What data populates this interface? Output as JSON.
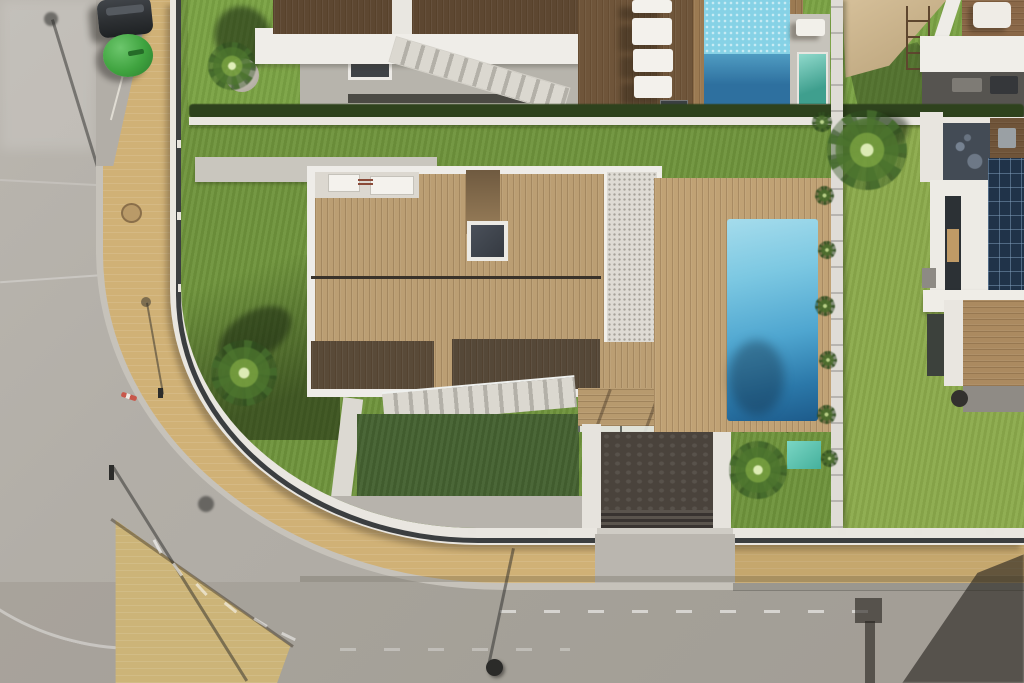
{
  "scene": {
    "description": "Aerial top-down drone photograph of a modern villa block: central house with wooden roof deck, gravel strip and rectangular swimming pool, artificial-grass lawns, neighbouring villas with sun loungers, plunge pool, beige shade sail and rooftop solar panels, all bordered by a curving asphalt street with tan paved sidewalks",
    "time_of_day": "sunny midday, hard shadows",
    "palette": {
      "road": "#b2aea7",
      "road_bottom": "#aaa69e",
      "sidewalk_tan": "#d0b176",
      "paved_island": "#ccb478",
      "concrete_apron": "#bab6af",
      "grass_main": "#6f943c",
      "grass_top": "#7ba344",
      "grass_bright": "#8cab4c",
      "grass_shadow": "#446130",
      "hedge_dark": "#2e421d",
      "wall_white": "#e9e6e0",
      "fence_dark": "#3b3e40",
      "deck_wood_light": "#bb9e73",
      "deck_wood_dark": "#594a38",
      "roof_wood_dark": "#5d4731",
      "lounger_deck": "#6f553a",
      "gravel": "#dedbd4",
      "pool_shallow": "#a5dcec",
      "pool_deep": "#1d5b8b",
      "top_pool_light": "#86d2e6",
      "top_pool_dark": "#2e709f",
      "plunge_pool_teal": "#52b3a2",
      "teal_mat": "#5cc6b2",
      "shade_sail": "#c7b08a",
      "solar_panel": "#203349",
      "driveway_dark": "#4a433c",
      "car_dark": "#2d3033",
      "waste_bin_green": "#3fa33f",
      "cast_shadow": "rgba(38,35,31,0.62)"
    },
    "objects": {
      "villas": 4,
      "swimming_pools": 2,
      "plunge_pools": 1,
      "sun_loungers": 5,
      "palm_trees": 5,
      "shrubs_along_fence": 7,
      "shade_sails": 1,
      "solar_panel_arrays": 1,
      "parked_cars": 1,
      "green_waste_containers": 1,
      "street_lamps": 4,
      "driveway_entrances": 1
    },
    "labels": {
      "stage": "aerial photo of villas and street",
      "main_pool": "main swimming pool",
      "main_deck": "wooden roof deck of central villa",
      "street": "curving asphalt street",
      "sidewalk": "tan paved sidewalk"
    }
  }
}
